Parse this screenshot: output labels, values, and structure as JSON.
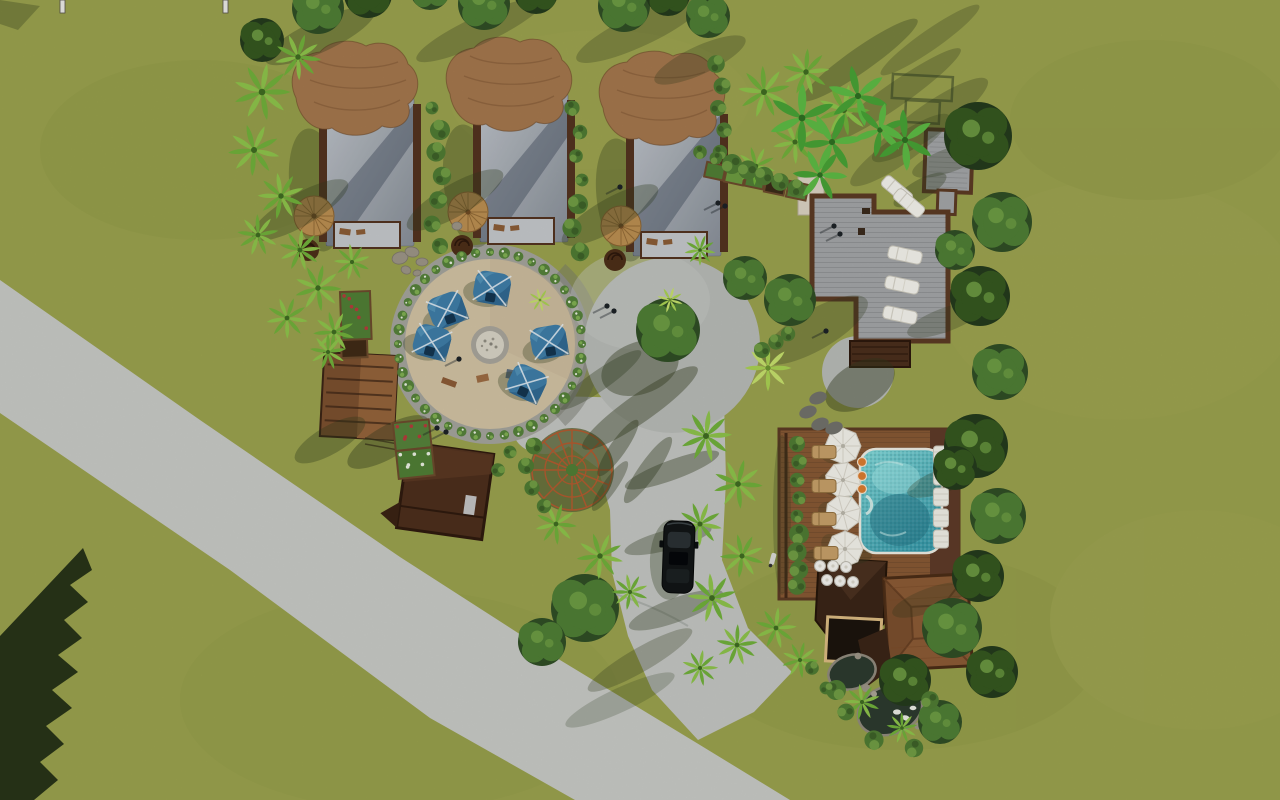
{
  "scene": {
    "type": "3d-aerial-architectural-render",
    "subject": "Tropical eco-resort site plan, top-down aerial view",
    "description": "Green lawn crossed by a diagonal grey road; three safari-tent bungalows with thatch roofs; sandy fire-pit circle with five blue canopy tents; central paved plaza with a tree; timber deck complex with white sun loungers; pool deck with four white umbrellas and a turquoise pool; restaurant building with hip roof; koi pond; dense tropical planting; black car on the driveway"
  },
  "palette": {
    "grass": "#99a04d",
    "grassMottle": "#8a9245",
    "road": "#c6c8c4",
    "driveway": "#c2c4c0",
    "plaza": "#b6b9b5",
    "sand": "#cfc0a2",
    "sandRing": "#a3a39b",
    "hedge": "#4e7a33",
    "tentBlue": "#3e7ca6",
    "thatch": "#a3764c",
    "hutBody": "#9aa0a7",
    "woodFrame": "#53331f",
    "deckFloor": "#a2a4a6",
    "deckFrame": "#5b3a24",
    "poolWater": "#56bcc0",
    "poolDeck": "#865834",
    "poolDeckDark": "#5d3a28",
    "umbrellaWhite": "#f1efe8",
    "loungerTan": "#c59e68",
    "roofBrown": "#8a5a35",
    "roofBrownDark": "#6b4225",
    "darkRoof": "#38231498",
    "barRoof": "#3a2517",
    "pond": "#2c3a2e",
    "stone": "#9b9486",
    "treeGreen": "#4e7d35",
    "treeDark": "#35571f",
    "palmGreen": "#6fae3a",
    "shadow": "#2f3a1c",
    "carBlack": "#121516",
    "trellis": "#b05a2f",
    "accentOrange": "#d97b2f"
  },
  "siteObjects": {
    "bungalows": [
      [
        286,
        40
      ],
      [
        440,
        36
      ],
      [
        593,
        50
      ]
    ],
    "blueTents": [
      [
        492,
        288,
        10
      ],
      [
        447,
        310,
        -20
      ],
      [
        432,
        342,
        15
      ],
      [
        549,
        342,
        -10
      ],
      [
        527,
        383,
        25
      ]
    ],
    "firePit": {
      "cx": 490,
      "cy": 345
    },
    "hedgeRing": {
      "cx": 490,
      "cy": 344,
      "r": 92,
      "count": 40
    },
    "domeTrellis": {
      "cx": 572,
      "cy": 470,
      "r": 40
    },
    "poolUmbrellas": [
      [
        843,
        446
      ],
      [
        843,
        480
      ],
      [
        843,
        513
      ],
      [
        845,
        549
      ]
    ],
    "tanLoungers": [
      [
        824,
        452
      ],
      [
        824,
        486
      ],
      [
        824,
        519
      ],
      [
        826,
        553
      ]
    ],
    "deckLoungersWhite": [
      [
        905,
        255,
        12
      ],
      [
        902,
        285,
        12
      ],
      [
        900,
        315,
        12
      ],
      [
        897,
        190,
        40
      ],
      [
        909,
        203,
        40
      ]
    ],
    "poolSideLoungers": [
      [
        941,
        455
      ],
      [
        941,
        476
      ],
      [
        941,
        497
      ],
      [
        941,
        518
      ],
      [
        941,
        539
      ]
    ],
    "orangeStools": [
      [
        862,
        462
      ],
      [
        862,
        476
      ],
      [
        862,
        489
      ]
    ],
    "whiteStools": [
      [
        820,
        566
      ],
      [
        833,
        566
      ],
      [
        846,
        567
      ],
      [
        827,
        580
      ],
      [
        840,
        581
      ],
      [
        853,
        582
      ]
    ],
    "steppingStones": [
      [
        818,
        398
      ],
      [
        808,
        412
      ],
      [
        820,
        424
      ],
      [
        834,
        428
      ]
    ],
    "gardenBeds": [
      [
        341,
        293,
        28,
        46,
        -2,
        "#4f7d35",
        "red"
      ],
      [
        342,
        341,
        24,
        16,
        -2,
        "#3f2a16",
        "none"
      ],
      [
        394,
        424,
        34,
        26,
        -6,
        "#55813a",
        "red"
      ],
      [
        397,
        452,
        34,
        26,
        -6,
        "#4f7d35",
        "white"
      ],
      [
        708,
        163,
        17,
        13,
        12,
        "#4f7d35",
        "none"
      ],
      [
        728,
        168,
        17,
        13,
        12,
        "#6b9a3f",
        "none"
      ],
      [
        748,
        172,
        17,
        13,
        12,
        "#4f7d35",
        "none"
      ],
      [
        768,
        177,
        18,
        14,
        12,
        "#3a2a18",
        "none"
      ],
      [
        790,
        182,
        18,
        14,
        12,
        "#56823a",
        "none"
      ]
    ],
    "stones": [
      [
        400,
        258,
        8,
        6,
        -15
      ],
      [
        412,
        252,
        7,
        5,
        10
      ],
      [
        422,
        262,
        6,
        4,
        0
      ],
      [
        406,
        270,
        5,
        4,
        20
      ],
      [
        417,
        273,
        4,
        3,
        -10
      ],
      [
        457,
        226,
        5,
        4,
        0
      ]
    ],
    "topStakes": [
      [
        60,
        0
      ],
      [
        223,
        0
      ]
    ],
    "people": [
      [
        607,
        306
      ],
      [
        614,
        311
      ],
      [
        834,
        226
      ],
      [
        840,
        234
      ],
      [
        718,
        203
      ],
      [
        725,
        206
      ],
      [
        620,
        187
      ],
      [
        459,
        359
      ],
      [
        826,
        331
      ],
      [
        437,
        428
      ],
      [
        446,
        432
      ]
    ],
    "car": {
      "x": 663,
      "y": 521,
      "w": 31,
      "h": 72
    },
    "scooter": [
      773,
      560
    ]
  },
  "vegetation": {
    "palms": [
      [
        262,
        92,
        1.1
      ],
      [
        298,
        57,
        0.9
      ],
      [
        254,
        150,
        1.0
      ],
      [
        281,
        196,
        0.9
      ],
      [
        258,
        235,
        0.8
      ],
      [
        300,
        250,
        0.8
      ],
      [
        318,
        288,
        0.9
      ],
      [
        287,
        318,
        0.8
      ],
      [
        334,
        332,
        0.8
      ],
      [
        352,
        262,
        0.7
      ],
      [
        328,
        352,
        0.7
      ],
      [
        706,
        436,
        1.0
      ],
      [
        738,
        484,
        0.95
      ],
      [
        700,
        524,
        0.85
      ],
      [
        742,
        556,
        0.85
      ],
      [
        712,
        598,
        0.95
      ],
      [
        737,
        645,
        0.8
      ],
      [
        700,
        668,
        0.7
      ],
      [
        556,
        524,
        0.8
      ],
      [
        600,
        556,
        0.9
      ],
      [
        630,
        592,
        0.7
      ],
      [
        764,
        92,
        1.0
      ],
      [
        806,
        72,
        0.9
      ],
      [
        844,
        110,
        1.0
      ],
      [
        795,
        142,
        0.85
      ],
      [
        756,
        166,
        0.75
      ],
      [
        862,
        702,
        0.7
      ],
      [
        902,
        728,
        0.6
      ],
      [
        776,
        628,
        0.8
      ],
      [
        800,
        660,
        0.7
      ],
      [
        700,
        250,
        0.6
      ]
    ],
    "palmsBright": [
      [
        768,
        368,
        0.9
      ],
      [
        670,
        300,
        0.5
      ],
      [
        540,
        300,
        0.45
      ]
    ],
    "bananas": [
      [
        802,
        118,
        1.0
      ],
      [
        832,
        142,
        0.9
      ],
      [
        858,
        96,
        0.9
      ],
      [
        880,
        130,
        0.8
      ],
      [
        820,
        175,
        0.8
      ],
      [
        905,
        140,
        0.9
      ]
    ],
    "trees": [
      [
        978,
        136,
        34,
        "dark"
      ],
      [
        1002,
        222,
        30,
        "mid"
      ],
      [
        980,
        296,
        30,
        "dark"
      ],
      [
        1000,
        372,
        28,
        "mid"
      ],
      [
        976,
        446,
        32,
        "dark"
      ],
      [
        998,
        516,
        28,
        "mid"
      ],
      [
        978,
        576,
        26,
        "dark"
      ],
      [
        952,
        628,
        30,
        "mid"
      ],
      [
        992,
        672,
        26,
        "dark"
      ],
      [
        955,
        250,
        20,
        "mid"
      ],
      [
        955,
        468,
        22,
        "dark"
      ],
      [
        585,
        608,
        34,
        "mid"
      ],
      [
        542,
        642,
        24,
        "mid"
      ],
      [
        790,
        300,
        26,
        "mid"
      ],
      [
        745,
        278,
        22,
        "mid"
      ],
      [
        318,
        8,
        26,
        "mid"
      ],
      [
        368,
        -6,
        24,
        "dark"
      ],
      [
        484,
        4,
        26,
        "mid"
      ],
      [
        536,
        -8,
        22,
        "dark"
      ],
      [
        624,
        6,
        26,
        "mid"
      ],
      [
        668,
        -6,
        22,
        "dark"
      ],
      [
        708,
        16,
        22,
        "mid"
      ],
      [
        430,
        -10,
        20,
        "mid"
      ],
      [
        262,
        40,
        22,
        "dark"
      ],
      [
        905,
        680,
        26,
        "dark"
      ],
      [
        940,
        722,
        22,
        "mid"
      ]
    ],
    "plazaTree": [
      668,
      330,
      32
    ],
    "bushes": [
      [
        432,
        108
      ],
      [
        440,
        130
      ],
      [
        436,
        152
      ],
      [
        442,
        176
      ],
      [
        438,
        200
      ],
      [
        432,
        224
      ],
      [
        440,
        246
      ],
      [
        572,
        108
      ],
      [
        580,
        132
      ],
      [
        576,
        156
      ],
      [
        582,
        180
      ],
      [
        578,
        204
      ],
      [
        572,
        228
      ],
      [
        580,
        252
      ],
      [
        716,
        64
      ],
      [
        722,
        86
      ],
      [
        718,
        108
      ],
      [
        724,
        130
      ],
      [
        720,
        152
      ],
      [
        700,
        152
      ],
      [
        716,
        158
      ],
      [
        732,
        164
      ],
      [
        748,
        170
      ],
      [
        764,
        176
      ],
      [
        780,
        182
      ],
      [
        796,
        188
      ],
      [
        797,
        444
      ],
      [
        799,
        462
      ],
      [
        797,
        480
      ],
      [
        799,
        498
      ],
      [
        797,
        516
      ],
      [
        799,
        534
      ],
      [
        797,
        552
      ],
      [
        799,
        570
      ],
      [
        797,
        586
      ],
      [
        534,
        446
      ],
      [
        526,
        466
      ],
      [
        532,
        488
      ],
      [
        544,
        506
      ],
      [
        498,
        470
      ],
      [
        510,
        452
      ],
      [
        836,
        690
      ],
      [
        874,
        740
      ],
      [
        914,
        748
      ],
      [
        930,
        700
      ],
      [
        846,
        712
      ],
      [
        762,
        350
      ],
      [
        776,
        342
      ],
      [
        788,
        334
      ],
      [
        812,
        668
      ],
      [
        826,
        688
      ]
    ]
  },
  "groundShadows": [
    [
      320,
      36,
      60,
      16,
      -25,
      0.32
    ],
    [
      480,
      30,
      70,
      14,
      -25,
      0.28
    ],
    [
      640,
      30,
      70,
      16,
      -25,
      0.28
    ],
    [
      700,
      60,
      50,
      14,
      -25,
      0.28
    ],
    [
      860,
      60,
      70,
      12,
      -35,
      0.32
    ],
    [
      895,
      95,
      80,
      12,
      -35,
      0.28
    ],
    [
      930,
      40,
      60,
      10,
      -35,
      0.26
    ],
    [
      300,
      210,
      55,
      16,
      -30,
      0.32
    ],
    [
      455,
      200,
      55,
      16,
      -30,
      0.32
    ],
    [
      610,
      215,
      55,
      16,
      -30,
      0.32
    ],
    [
      672,
      470,
      50,
      10,
      -20,
      0.38
    ],
    [
      668,
      540,
      45,
      10,
      -15,
      0.33
    ],
    [
      676,
      610,
      50,
      12,
      -20,
      0.33
    ],
    [
      640,
      660,
      60,
      12,
      -30,
      0.28
    ],
    [
      618,
      448,
      34,
      8,
      -55,
      0.4
    ],
    [
      648,
      470,
      40,
      9,
      -55,
      0.38
    ],
    [
      610,
      486,
      30,
      7,
      -55,
      0.35
    ],
    [
      640,
      408,
      70,
      14,
      -35,
      0.4
    ],
    [
      600,
      380,
      50,
      10,
      -35,
      0.33
    ],
    [
      640,
      368,
      40,
      26,
      -20,
      0.4
    ],
    [
      815,
      330,
      60,
      20,
      -30,
      0.28
    ],
    [
      860,
      385,
      38,
      22,
      -30,
      0.42
    ],
    [
      782,
      515,
      9,
      80,
      0,
      0.25
    ],
    [
      950,
      160,
      40,
      12,
      -20,
      0.28
    ],
    [
      945,
      320,
      40,
      12,
      -20,
      0.28
    ],
    [
      945,
      480,
      40,
      12,
      -20,
      0.28
    ],
    [
      930,
      600,
      40,
      12,
      -20,
      0.26
    ],
    [
      930,
      120,
      70,
      16,
      -35,
      0.28
    ],
    [
      900,
      150,
      60,
      14,
      -35,
      0.26
    ],
    [
      920,
      190,
      30,
      10,
      -30,
      0.33
    ],
    [
      388,
      442,
      46,
      16,
      -30,
      0.38
    ],
    [
      330,
      440,
      40,
      14,
      -30,
      0.33
    ],
    [
      838,
      556,
      34,
      10,
      0,
      0.28
    ],
    [
      620,
      700,
      60,
      12,
      -25,
      0.22
    ]
  ]
}
